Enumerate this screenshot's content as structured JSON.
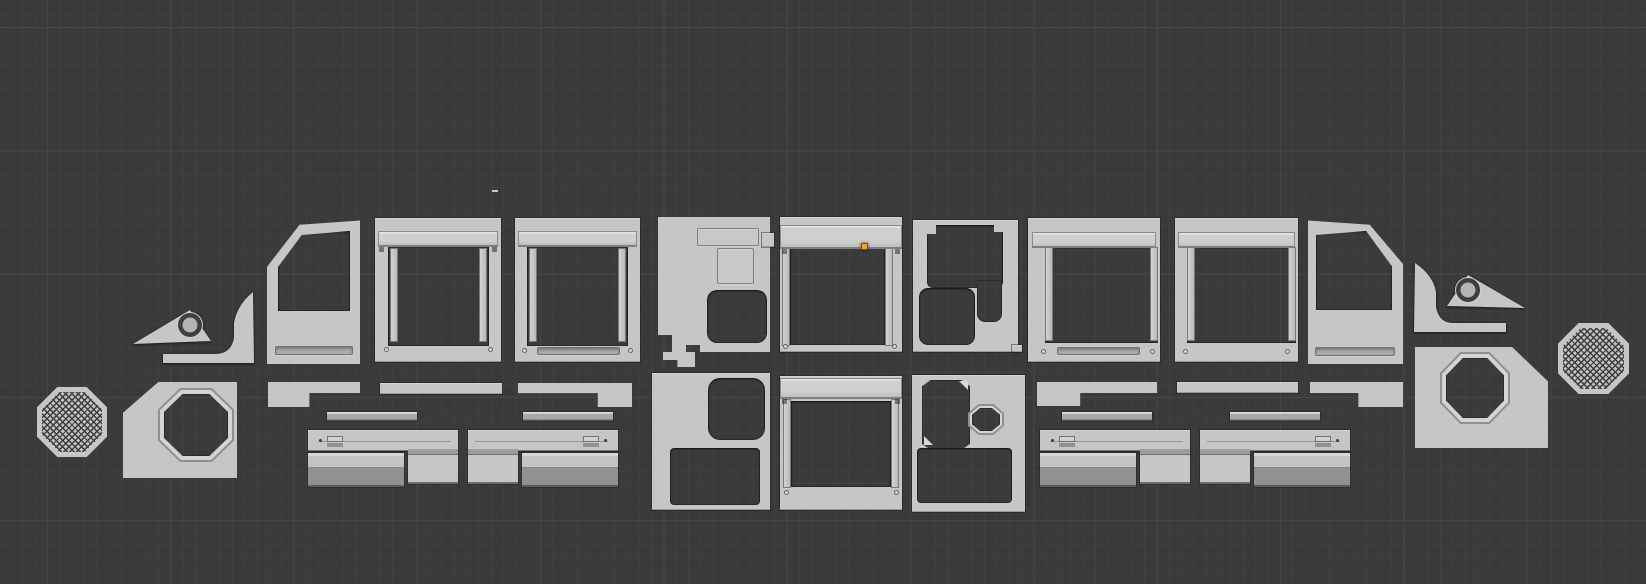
{
  "palette": {
    "bg": "#3a3a3c",
    "grid_minor": "#404043",
    "grid_major": "#47474a",
    "part": "#c5c7c4",
    "part_light": "#d7d8d5",
    "part_shade": "#a9aba8",
    "part_mid": "#90928f",
    "part_dark": "#737572",
    "outline": "#232423",
    "boss_dark": "#3f403e",
    "mesh_dot": "#3c3d3b",
    "origin": "#ff9d2b",
    "screw": "#d8d9d6"
  },
  "origin_marker": {
    "x": 861,
    "y": 243
  },
  "stray_dash": {
    "x": 492,
    "y": 190
  },
  "parts": [
    "mesh-octagon-left",
    "octagon-hole-panel-left",
    "wing-triangle-left",
    "wing-hook-left",
    "door-panel-left",
    "window-frame-1",
    "window-frame-2",
    "mid-panel-left",
    "center-window-frame-top",
    "mid-panel-right",
    "window-frame-3",
    "window-frame-4",
    "door-panel-right",
    "wing-hook-right",
    "wing-triangle-right",
    "octagon-hole-panel-right",
    "mesh-octagon-right",
    "rocker-strip-left-a",
    "rocker-strip-left-b",
    "rocker-strip-left-c",
    "rail-strip-left-1",
    "rail-strip-left-2",
    "step-assembly-left-1",
    "step-assembly-left-2",
    "rocker-strip-right-a",
    "rocker-strip-right-b",
    "rocker-strip-right-c",
    "rail-strip-right-1",
    "rail-strip-right-2",
    "step-assembly-right-1",
    "step-assembly-right-2",
    "bottom-panel-left",
    "center-window-frame-bottom",
    "bottom-panel-right"
  ]
}
